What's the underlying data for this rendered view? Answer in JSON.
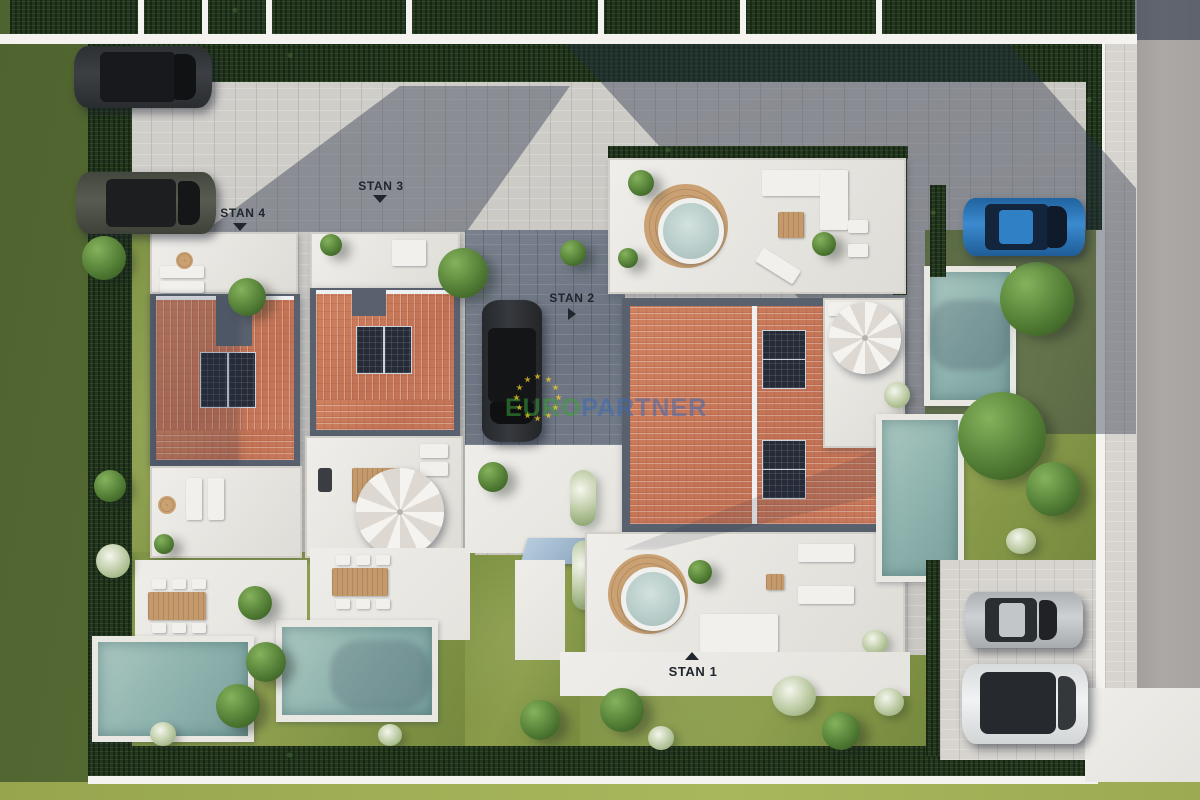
{
  "scene": {
    "description": "Aerial 3D architectural site plan of four residential units with pools, terraces and parking",
    "annotations": {
      "stan1": {
        "label": "STAN 1",
        "arrow": "up"
      },
      "stan2": {
        "label": "STAN 2",
        "arrow": "right"
      },
      "stan3": {
        "label": "STAN 3",
        "arrow": "down"
      },
      "stan4": {
        "label": "STAN 4",
        "arrow": "down"
      }
    },
    "watermark": {
      "part1": "EURO",
      "part2": "PARTNER",
      "part1_color": "#3aa037",
      "part2_color": "#3c69b2",
      "stars_color": "#f3cd28"
    },
    "palette": {
      "lawn_outer": "#5c7034",
      "lawn_bright": "#a3b156",
      "lawn_inner": "#86984a",
      "hedge": "#24351f",
      "pavers": "#cac8c3",
      "terrace": "#edebe7",
      "roof_tiles": "#c5795b",
      "roof_frame": "#59616e",
      "solar_panel": "#262b38",
      "pool_water": "#8fb3ae",
      "wood": "#c49a6c",
      "road": "#a9a6a4",
      "car_dark": "#33363a",
      "car_olive": "#53564c",
      "car_blue": "#2f80c4",
      "car_silver": "#c9ccce",
      "car_white": "#eff1f2",
      "label_text": "#20262e"
    }
  }
}
